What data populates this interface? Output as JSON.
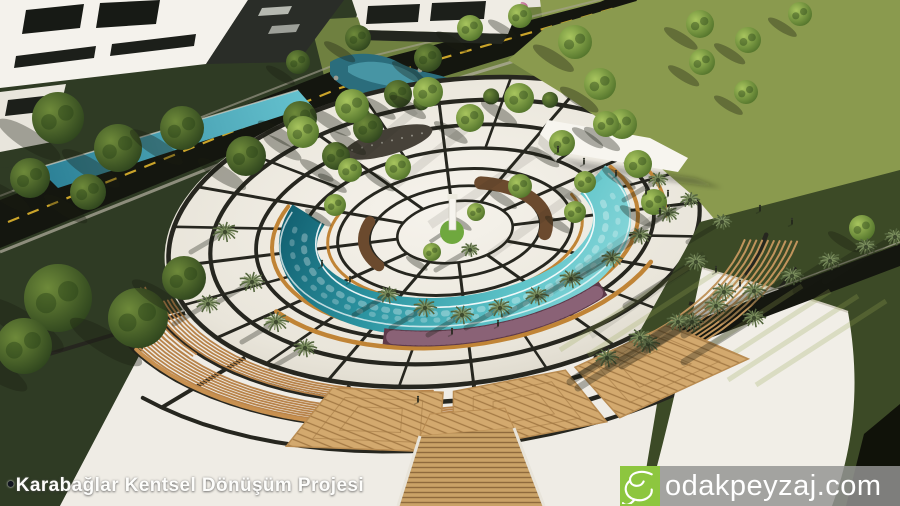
{
  "caption": {
    "bullet": "•",
    "text": "Karabağlar Kentsel Dönüşüm Projesi"
  },
  "watermark": {
    "domain": "odakpeyzaj.com",
    "logo_icon": "script-e-swirl-icon",
    "logo_color": "#8dc63f",
    "bar_color": "rgba(148,148,146,0.84)",
    "text_color": "#ffffff"
  },
  "palette": {
    "pavement": "#edeae2",
    "pavement_shade": "#d8d3c6",
    "ring": "#26261f",
    "pool_deep": "#0f5a6b",
    "pool_light": "#93dcde",
    "bench_gold": "#c08436",
    "wood": "#d3a96e",
    "wood_line": "#a47a45",
    "lawn_bright": "#8a9a4e",
    "lawn_mid": "#6f8040",
    "lawn_dark": "#3c4a26",
    "veg_dark": "#2f3b24",
    "road": "#14160f",
    "road_line": "#caa42a",
    "path_light": "#b3ae9e",
    "building": "#f4f2ec",
    "building_side": "#d8d5cc",
    "roof_dark": "#2a2d28",
    "tree_light": "#9ab94f",
    "tree_dark": "#4a6b28",
    "palm": "#7e9160",
    "palm_dark": "#55663f",
    "flower_pink": "#c97fae",
    "planting_purple": "#5e3a4a",
    "mulch": "#6b4a2e",
    "water_channel": "#3fa3b5",
    "shadow": "rgba(25,30,18,0.35)"
  }
}
